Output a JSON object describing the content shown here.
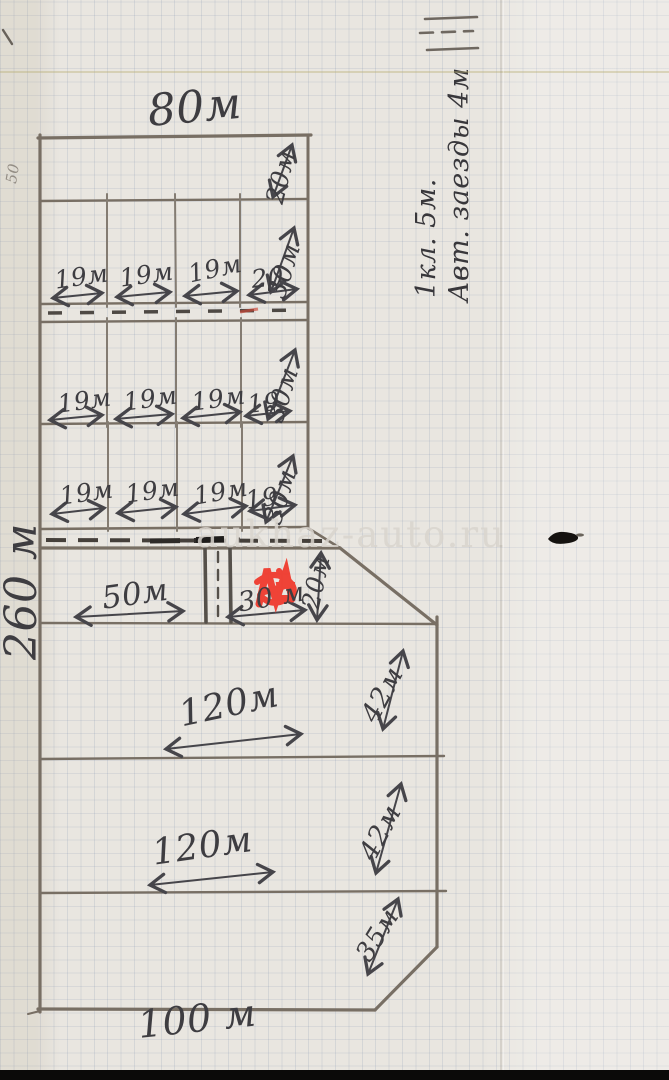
{
  "colors": {
    "paper": "#e9e6e0",
    "grid_line": "#7084a8",
    "pencil": "#7b746b",
    "ink": "#3e3d41",
    "red_marker": "#f03b2e"
  },
  "watermark": "aukhaz-auto.ru",
  "page_note": {
    "line1": "1кл. 5м.",
    "line2": "Авт. заезды 4м"
  },
  "margin_note": "50",
  "plot": {
    "top_width": "80м",
    "left_height": "260 м",
    "bottom_width": "100 м",
    "top_strip_depth": "20м",
    "rows": [
      {
        "depth": "30м",
        "cells": [
          "19м",
          "19м",
          "19м",
          "20"
        ]
      },
      {
        "depth": "30м",
        "cells": [
          "19м",
          "19м",
          "19м",
          "19"
        ]
      },
      {
        "depth": "30м",
        "cells": [
          "19м",
          "19м",
          "19м",
          "19"
        ]
      }
    ],
    "mid_row": {
      "left": "50м",
      "right": "30 м",
      "depth": "20м"
    },
    "sections": [
      {
        "width": "120м",
        "side": "42м"
      },
      {
        "width": "120м",
        "side": "42м"
      },
      {
        "side": "35м"
      }
    ]
  }
}
